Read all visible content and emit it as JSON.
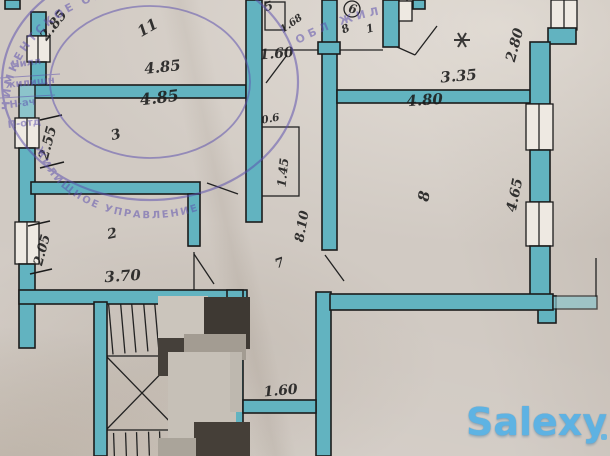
{
  "labels": {
    "diag_285": "2.85",
    "tally": "11",
    "width_485_top": "4.85",
    "width_485_room3": "4.85",
    "height_255": "2.55",
    "room_3": "3",
    "door_160_top": "1.60",
    "bath_mark_a": "5",
    "bath_mark_b": "1.68",
    "wc_mark_a": "6",
    "wc_mark_b": "8",
    "wc_mark_c": "1",
    "height_280": "2.80",
    "width_335": "3.35",
    "width_480": "4.80",
    "height_465": "4.65",
    "closet_06": "0.6",
    "closet_145": "1.45",
    "height_810": "8.10",
    "room_8": "8",
    "room_7": "7",
    "height_205": "2.05",
    "room_2": "2",
    "width_370": "3.70",
    "door_160_bottom": "1.60"
  },
  "stamp": {
    "ring_top": "ЧИМКЕНТСКОЕ ОБЛАСТНОЕ",
    "ring_bottom": "ЖИЛИЩНОЕ УПРАВЛЕНИЕ",
    "line_1": "Чилл",
    "line_2": "жилищн",
    "line_3": "Н-ач",
    "line_4": "П-отд",
    "arc_right": "ОБЛ ЖИЛ",
    "color": "#5b4fae"
  },
  "watermark": {
    "text": "Salexy",
    "color": "#55b1e6"
  },
  "colors": {
    "wall": "#62b3c0",
    "ink": "#1b1b1b",
    "paper": "#d1cac3"
  }
}
